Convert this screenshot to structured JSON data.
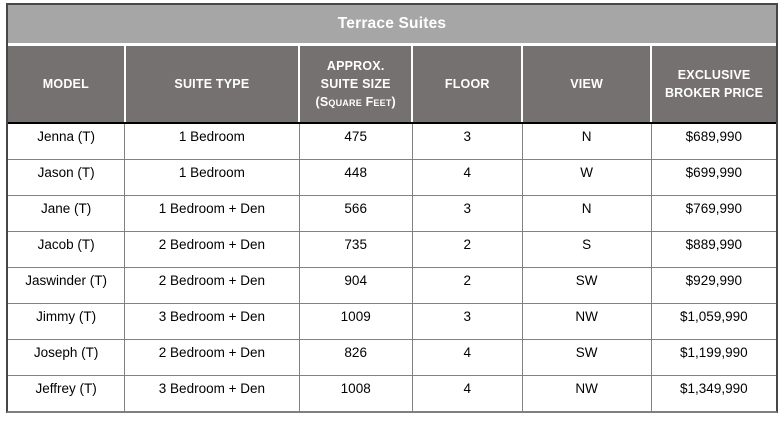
{
  "title": "Terrace Suites",
  "table": {
    "column_keys": [
      "model",
      "suite_type",
      "suite_size",
      "floor",
      "view",
      "price"
    ],
    "headers": [
      {
        "lines": [
          "MODEL"
        ]
      },
      {
        "lines": [
          "SUITE TYPE"
        ]
      },
      {
        "lines": [
          "APPROX.",
          "SUITE SIZE",
          "(Square Feet)"
        ]
      },
      {
        "lines": [
          "FLOOR"
        ]
      },
      {
        "lines": [
          "VIEW"
        ]
      },
      {
        "lines": [
          "EXCLUSIVE",
          "BROKER PRICE"
        ]
      }
    ],
    "rows": [
      [
        "Jenna (T)",
        "1 Bedroom",
        "475",
        "3",
        "N",
        "$689,990"
      ],
      [
        "Jason (T)",
        "1 Bedroom",
        "448",
        "4",
        "W",
        "$699,990"
      ],
      [
        "Jane (T)",
        "1 Bedroom + Den",
        "566",
        "3",
        "N",
        "$769,990"
      ],
      [
        "Jacob (T)",
        "2 Bedroom + Den",
        "735",
        "2",
        "S",
        "$889,990"
      ],
      [
        "Jaswinder (T)",
        "2 Bedroom + Den",
        "904",
        "2",
        "SW",
        "$929,990"
      ],
      [
        "Jimmy (T)",
        "3 Bedroom + Den",
        "1009",
        "3",
        "NW",
        "$1,059,990"
      ],
      [
        "Joseph (T)",
        "2 Bedroom + Den",
        "826",
        "4",
        "SW",
        "$1,199,990"
      ],
      [
        "Jeffrey (T)",
        "3 Bedroom + Den",
        "1008",
        "4",
        "NW",
        "$1,349,990"
      ]
    ]
  },
  "colors": {
    "title_bg": "#a6a6a6",
    "header_bg": "#767171",
    "header_text": "#ffffff",
    "body_bg": "#ffffff",
    "body_text": "#000000",
    "row_border": "#828282",
    "header_separator": "#ffffff",
    "header_bottom_border": "#000000",
    "outer_border": "#474747"
  }
}
